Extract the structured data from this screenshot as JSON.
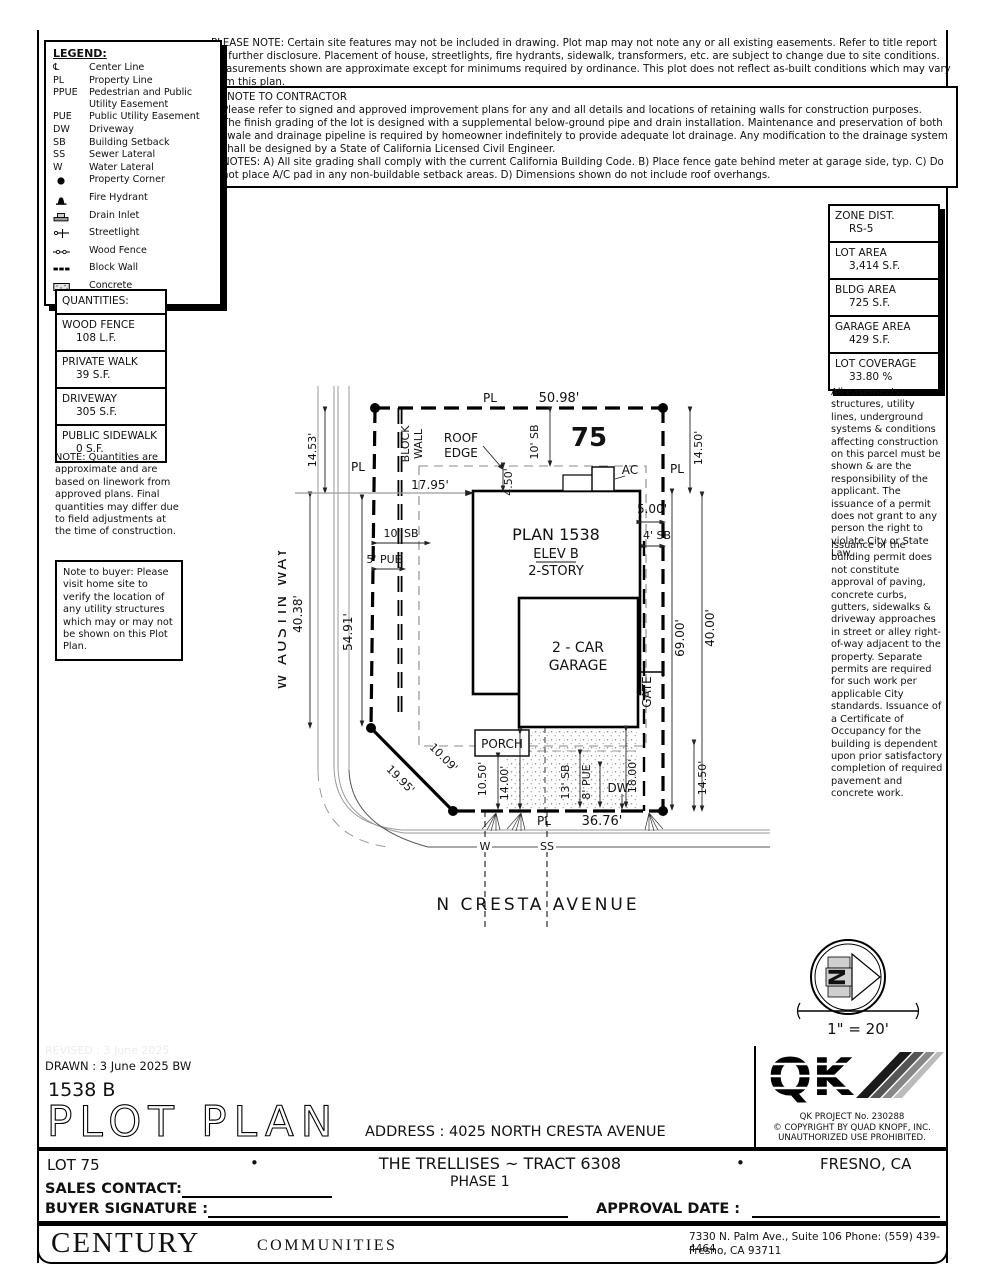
{
  "please_note": "PLEASE NOTE:  Certain site features may not be included in drawing.  Plot map may not note any or all existing easements. Refer to title report for further disclosure.  Placement of house, streetlights, fire hydrants, sidewalk, transformers, etc. are subject to change due to site conditions.  Measurements shown are approximate except for minimums required by ordinance.  This plot does not reflect as-built conditions which may vary from this plan.",
  "contractor_note": {
    "title": "*NOTE TO CONTRACTOR",
    "line1": "Please refer to signed and approved improvement plans for any and all details and locations of retaining walls for construction purposes.",
    "line2": "The finish grading of the lot is designed with a supplemental below-ground pipe and drain installation.  Maintenance and preservation of both swale and drainage pipeline is required by homeowner indefinitely to provide adequate lot drainage.  Any modification to the drainage system shall be designed by a State of California Licensed Civil Engineer.",
    "line3": "NOTES:  A) All site grading shall comply with the current California Building Code.  B) Place fence gate behind meter at garage side, typ.  C) Do not place A/C pad in any non-buildable setback areas.  D) Dimensions shown do not include roof overhangs."
  },
  "legend": {
    "title": "LEGEND:",
    "items": [
      {
        "key": "℄",
        "label": "Center Line"
      },
      {
        "key": "PL",
        "label": "Property Line"
      },
      {
        "key": "PPUE",
        "label": "Pedestrian and Public Utility Easement"
      },
      {
        "key": "PUE",
        "label": "Public Utility Easement"
      },
      {
        "key": "DW",
        "label": "Driveway"
      },
      {
        "key": "SB",
        "label": "Building Setback"
      },
      {
        "key": "SS",
        "label": "Sewer Lateral"
      },
      {
        "key": "W",
        "label": "Water Lateral"
      },
      {
        "icon": "property-corner-icon",
        "label": "Property Corner"
      },
      {
        "icon": "fire-hydrant-icon",
        "label": "Fire Hydrant"
      },
      {
        "icon": "drain-inlet-icon",
        "label": "Drain Inlet"
      },
      {
        "icon": "streetlight-icon",
        "label": "Streetlight"
      },
      {
        "icon": "wood-fence-icon",
        "label": "Wood Fence"
      },
      {
        "icon": "block-wall-icon",
        "label": "Block Wall"
      },
      {
        "icon": "concrete-icon",
        "label": "Concrete"
      }
    ]
  },
  "zoning": {
    "rows": [
      {
        "label": "ZONE DIST.",
        "value": "RS-5"
      },
      {
        "label": "LOT AREA",
        "value": "3,414 S.F."
      },
      {
        "label": "BLDG AREA",
        "value": "725 S.F."
      },
      {
        "label": "GARAGE AREA",
        "value": "429 S.F."
      },
      {
        "label": "LOT COVERAGE",
        "value": "33.80 %"
      }
    ]
  },
  "quantities": {
    "title": "QUANTITIES:",
    "rows": [
      {
        "label": "WOOD FENCE",
        "value": "108 L.F."
      },
      {
        "label": "PRIVATE WALK",
        "value": "39 S.F."
      },
      {
        "label": "DRIVEWAY",
        "value": "305 S.F."
      },
      {
        "label": "PUBLIC SIDEWALK",
        "value": "0 S.F."
      }
    ],
    "note": "NOTE: Quantities are approximate and are based on linework from approved plans.  Final quantities may differ due to field adjustments at the time of construction."
  },
  "buyer_note": "Note to buyer:  Please visit home site to verify the location of any utility structures which may or may not be shown on this Plot Plan.",
  "side_notes": {
    "para1": "All easements, structures, utility lines, underground systems & conditions affecting construction on this parcel must be shown & are the responsibility of the applicant. The issuance of a permit does not grant to any person the right to violate City or State Law.",
    "para2": "Issuance of the building permit does not constitute approval of paving, concrete curbs, gutters, sidewalks & driveway approaches in street or alley right-of-way adjacent to the property. Separate permits are required for such work per applicable City standards. Issuance of a Certificate of Occupancy for the building is dependent upon prior satisfactory completion of required pavement and concrete work."
  },
  "plot": {
    "lot_number": "75",
    "pl_top": "PL",
    "pl_left": "PL",
    "pl_right": "PL",
    "pl_bottom": "PL",
    "street_west": "W AUSTIN WAY",
    "street_south": "N CRESTA AVENUE",
    "block1": "BLOCK",
    "block2": "WALL",
    "roof1": "ROOF",
    "roof2": "EDGE",
    "plan": "PLAN 1538",
    "elev": "ELEV B",
    "story": "2-STORY",
    "car1": "2 - CAR",
    "car2": "GARAGE",
    "porch": "PORCH",
    "ac": "AC",
    "gate": "GATE",
    "dw": "DW",
    "w": "W",
    "ss": "SS",
    "dims": {
      "d5098": "50.98'",
      "d1453": "14.53'",
      "d1795": "17.95'",
      "sb10_left": "10' SB",
      "pue5": "5' PUE",
      "d4038": "40.38'",
      "d5491": "54.91'",
      "sb10_top": "10' SB",
      "d450": "4.50'",
      "d500": "5.00'",
      "sb4": "4' SB",
      "d1450_tr": "14.50'",
      "d4000": "40.00'",
      "d6900": "69.00'",
      "d1450_br": "14.50'",
      "d1995": "19.95'",
      "d1009": "10.09'",
      "d1050": "10.50'",
      "d1400": "14.00'",
      "sb13": "13' SB",
      "pue8": "8' PUE",
      "d1800": "18.00'",
      "d3676": "36.76'"
    }
  },
  "north": {
    "letter": "N",
    "scale": "1\" = 20'"
  },
  "qk": {
    "logo": "QK",
    "project": "QK PROJECT No. 230288",
    "copyright": "©  COPYRIGHT BY QUAD KNOPF, INC.",
    "prohibited": "UNAUTHORIZED USE PROHIBITED."
  },
  "titleblock": {
    "revised": "REVISED :  3 June 2025",
    "drawn": "DRAWN :  3 June 2025  BW",
    "plan_code": "1538  B",
    "title": "PLOT PLAN",
    "address_label": "ADDRESS :  4025 NORTH CRESTA AVENUE",
    "lot": "LOT 75",
    "bullet1": "•",
    "tract": "THE TRELLISES ~ TRACT 6308",
    "bullet2": "•",
    "phase": "PHASE 1",
    "city": "FRESNO, CA",
    "sales_contact": "SALES CONTACT:",
    "buyer_signature": "BUYER SIGNATURE :",
    "approval_date": "APPROVAL DATE :",
    "century": "CENTURY",
    "communities": "COMMUNITIES",
    "footer_addr1": "7330 N. Palm Ave., Suite 106    Phone:  (559) 439-4464",
    "footer_addr2": "Fresno, CA  93711"
  },
  "colors": {
    "ink": "#000000",
    "gray_line": "#999999",
    "concrete_dot": "#8a8a8a"
  }
}
